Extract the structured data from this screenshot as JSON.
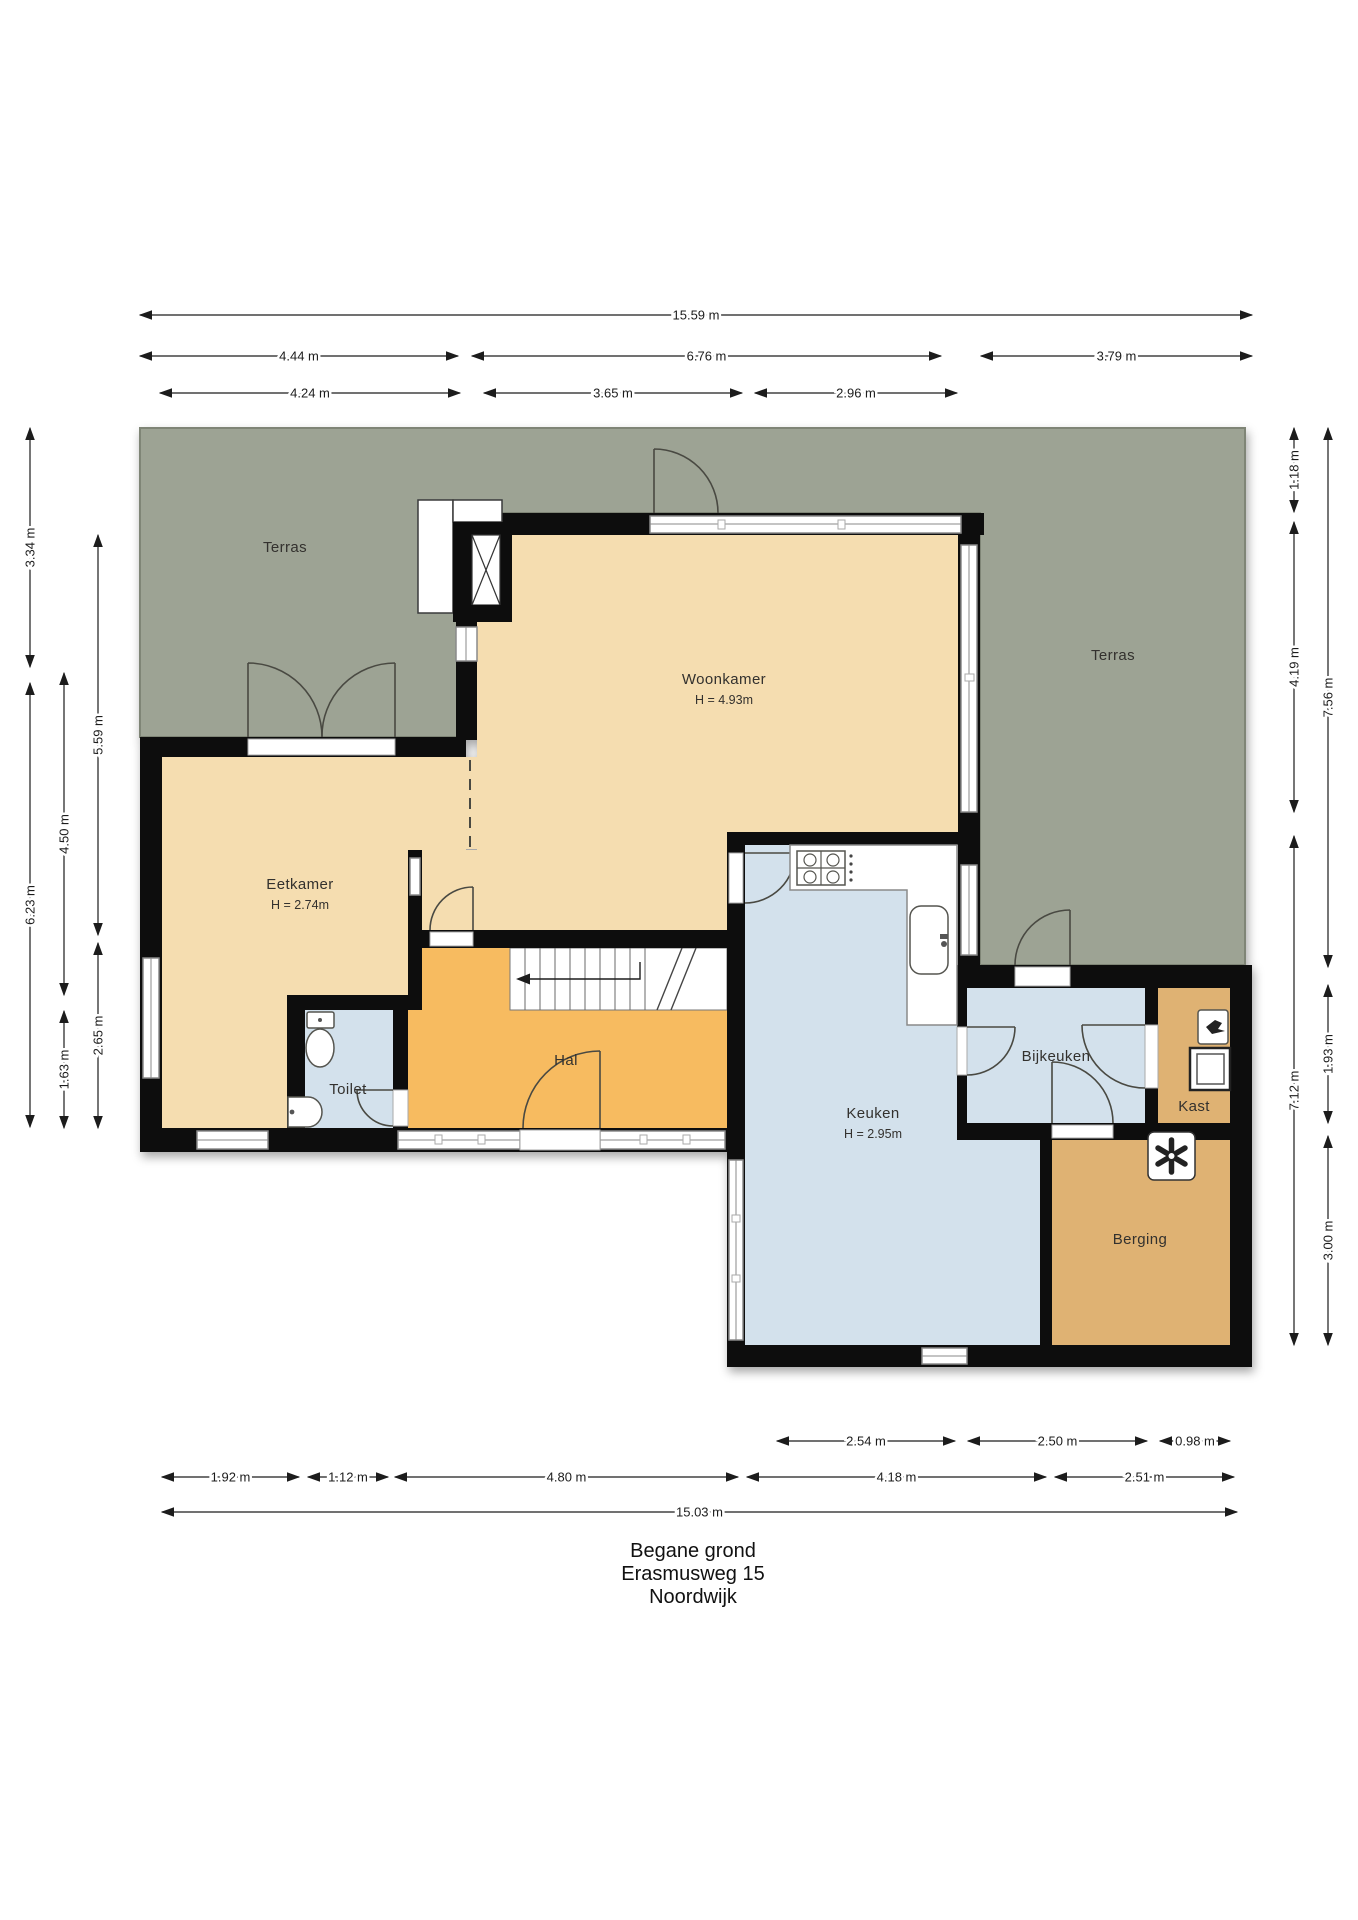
{
  "title": {
    "line1": "Begane grond",
    "line2": "Erasmusweg 15",
    "line3": "Noordwijk",
    "x": 693,
    "y": 1540
  },
  "rooms": [
    {
      "id": "terras-left",
      "label": "Terras",
      "sub": "",
      "x": 285,
      "y": 552
    },
    {
      "id": "terras-right",
      "label": "Terras",
      "sub": "",
      "x": 1113,
      "y": 660
    },
    {
      "id": "woonkamer",
      "label": "Woonkamer",
      "sub": "H = 4.93m",
      "x": 724,
      "y": 684
    },
    {
      "id": "eetkamer",
      "label": "Eetkamer",
      "sub": "H = 2.74m",
      "x": 300,
      "y": 889
    },
    {
      "id": "hal",
      "label": "Hal",
      "sub": "",
      "x": 566,
      "y": 1065
    },
    {
      "id": "toilet",
      "label": "Toilet",
      "sub": "",
      "x": 348,
      "y": 1094
    },
    {
      "id": "keuken",
      "label": "Keuken",
      "sub": "H = 2.95m",
      "x": 873,
      "y": 1118
    },
    {
      "id": "bijkeuken",
      "label": "Bijkeuken",
      "sub": "",
      "x": 1056,
      "y": 1061
    },
    {
      "id": "kast",
      "label": "Kast",
      "sub": "",
      "x": 1194,
      "y": 1111
    },
    {
      "id": "berging",
      "label": "Berging",
      "sub": "",
      "x": 1140,
      "y": 1244
    }
  ],
  "dimensions": {
    "top": [
      {
        "label": "15.59 m",
        "x1": 140,
        "x2": 1252,
        "y": 315
      },
      {
        "label": "4.44 m",
        "x1": 140,
        "x2": 458,
        "y": 356
      },
      {
        "label": "6.76 m",
        "x1": 472,
        "x2": 941,
        "y": 356
      },
      {
        "label": "3.79 m",
        "x1": 981,
        "x2": 1252,
        "y": 356
      },
      {
        "label": "4.24 m",
        "x1": 160,
        "x2": 460,
        "y": 393
      },
      {
        "label": "3.65 m",
        "x1": 484,
        "x2": 742,
        "y": 393
      },
      {
        "label": "2.96 m",
        "x1": 755,
        "x2": 957,
        "y": 393
      }
    ],
    "left": [
      {
        "label": "3.34 m",
        "y1": 428,
        "y2": 667,
        "x": 30
      },
      {
        "label": "6.23 m",
        "y1": 683,
        "y2": 1127,
        "x": 30
      },
      {
        "label": "4.50 m",
        "y1": 673,
        "y2": 995,
        "x": 64
      },
      {
        "label": "1.63 m",
        "y1": 1011,
        "y2": 1128,
        "x": 64
      },
      {
        "label": "5.59 m",
        "y1": 535,
        "y2": 935,
        "x": 98
      },
      {
        "label": "2.65 m",
        "y1": 943,
        "y2": 1128,
        "x": 98
      }
    ],
    "right": [
      {
        "label": "1.18 m",
        "y1": 428,
        "y2": 512,
        "x": 1294
      },
      {
        "label": "4.19 m",
        "y1": 522,
        "y2": 812,
        "x": 1294
      },
      {
        "label": "7.12 m",
        "y1": 836,
        "y2": 1345,
        "x": 1294
      },
      {
        "label": "7.56 m",
        "y1": 428,
        "y2": 967,
        "x": 1328
      },
      {
        "label": "1.93 m",
        "y1": 985,
        "y2": 1123,
        "x": 1328
      },
      {
        "label": "3.00 m",
        "y1": 1136,
        "y2": 1345,
        "x": 1328
      }
    ],
    "bottom": [
      {
        "label": "2.54 m",
        "x1": 777,
        "x2": 955,
        "y": 1441
      },
      {
        "label": "2.50 m",
        "x1": 968,
        "x2": 1147,
        "y": 1441
      },
      {
        "label": "0.98 m",
        "x1": 1160,
        "x2": 1230,
        "y": 1441
      },
      {
        "label": "1.92 m",
        "x1": 162,
        "x2": 299,
        "y": 1477
      },
      {
        "label": "1.12 m",
        "x1": 308,
        "x2": 388,
        "y": 1477
      },
      {
        "label": "4.80 m",
        "x1": 395,
        "x2": 738,
        "y": 1477
      },
      {
        "label": "4.18 m",
        "x1": 747,
        "x2": 1046,
        "y": 1477
      },
      {
        "label": "2.51 m",
        "x1": 1055,
        "x2": 1234,
        "y": 1477
      },
      {
        "label": "15.03 m",
        "x1": 162,
        "x2": 1237,
        "y": 1512
      }
    ]
  },
  "colors": {
    "terrace": "#9da394",
    "living": "#f5ddb0",
    "hall": "#f7bb61",
    "wet": "#d3e1ec",
    "storage": "#dfb273",
    "wall": "#0d0d0d",
    "dim_text": "#1c1c1c"
  }
}
